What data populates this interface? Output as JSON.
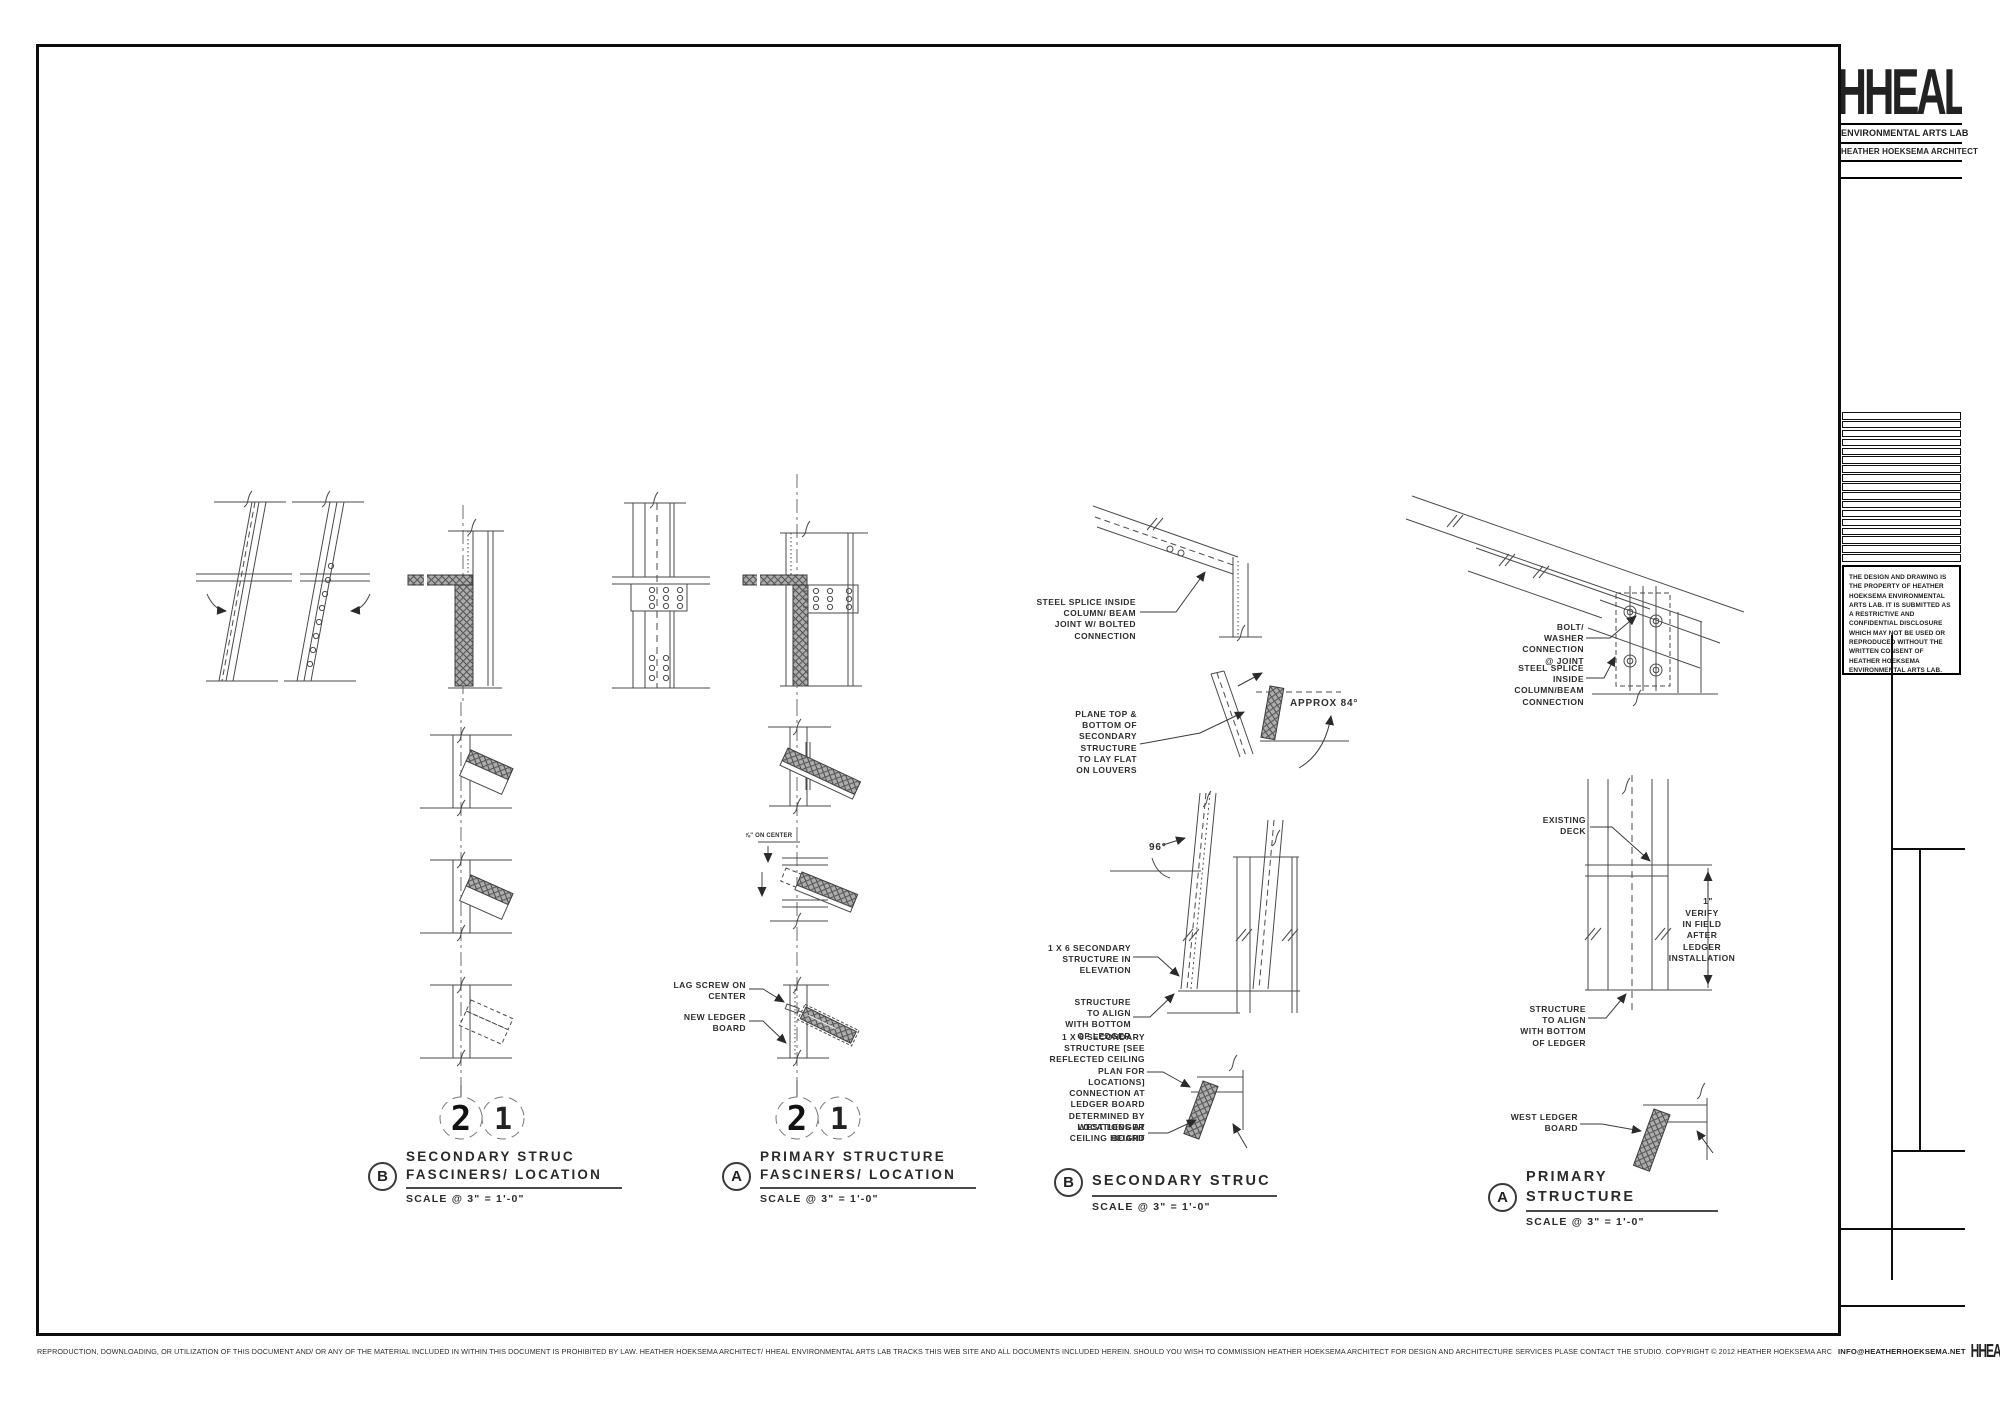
{
  "titleblock": {
    "logo": "HHEAL",
    "org": "ENVIRONMENTAL ARTS LAB",
    "architect": "HEATHER HOEKSEMA ARCHITECT",
    "disclaimer": "THE DESIGN AND DRAWING IS THE PROPERTY OF HEATHER HOEKSEMA ENVIRONMENTAL ARTS LAB.  IT IS SUBMITTED AS A RESTRICTIVE AND CONFIDENTIAL DISCLOSURE WHICH MAY NOT BE USED OR REPRODUCED WITHOUT THE WRITTEN CONSENT OF HEATHER HOEKSEMA ENVIRONMENTAL ARTS LAB."
  },
  "footer": {
    "legal": "REPRODUCTION, DOWNLOADING, OR UTILIZATION OF THIS DOCUMENT AND/ OR ANY OF THE MATERIAL INCLUDED IN WITHIN THIS DOCUMENT IS PROHIBITED BY LAW.  HEATHER HOEKSEMA ARCHITECT/ HHEAL ENVIRONMENTAL ARTS LAB TRACKS THIS WEB SITE AND ALL DOCUMENTS INCLUDED HEREIN.  SHOULD YOU WISH TO COMMISSION HEATHER HOEKSEMA ARCHITECT FOR DESIGN AND ARCHITECTURE SERVICES PLASE CONTACT THE STUDIO.   COPYRIGHT © 2012 HEATHER HOEKSEMA ARCHITECT/ HHEAL ENVIRONMENTAL ARTS LAB",
    "email": "INFO@HEATHERHOEKSEMA.NET",
    "logo": "HHEAL"
  },
  "colors": {
    "line": "#4a4a4a",
    "hatch_fill": "#a9a9a9",
    "ink": "#1c1c1c"
  },
  "panels": [
    {
      "letter": "B",
      "bubbles": {
        "left": "2",
        "right": "1"
      },
      "title": "SECONDARY STRUC\nFASCINERS/ LOCATION",
      "scale": "SCALE @ 3\" = 1'-0\""
    },
    {
      "letter": "A",
      "bubbles": {
        "left": "2",
        "right": "1"
      },
      "title": "PRIMARY STRUCTURE\nFASCINERS/ LOCATION",
      "scale": "SCALE @ 3\" = 1'-0\"",
      "annotations": {
        "dim_on_center": "⅞\" ON CENTER",
        "lag_screw": "LAG SCREW ON\nCENTER",
        "new_ledger": "NEW LEDGER\nBOARD"
      }
    },
    {
      "letter": "B",
      "title": "SECONDARY STRUC",
      "scale": "SCALE @ 3\" = 1'-0\"",
      "annotations": {
        "steel_splice": "STEEL SPLICE INSIDE\nCOLUMN/ BEAM\nJOINT W/ BOLTED\nCONNECTION",
        "plane": "PLANE TOP &\nBOTTOM OF\nSECONDARY\nSTRUCTURE\nTO LAY FLAT\nON LOUVERS",
        "approx_angle": "APPROX 84°",
        "angle_96": "96°",
        "elevation": "1 X 6 SECONDARY\nSTRUCTURE IN\nELEVATION",
        "align": "STRUCTURE\nTO ALIGN\nWITH BOTTOM\nOF LEDGER",
        "connection": "1 X 6 SECONDARY\nSTRUCTURE [SEE\nREFLECTED CEILING\nPLAN FOR\nLOCATIONS]\nCONNECTION AT\nLEDGER BOARD\nDETERMINED BY\nLOCATIONS AT\nCEILING HEIGHT",
        "west_ledger": "WEST LEDGER\nBOARD"
      }
    },
    {
      "letter": "A",
      "title": "PRIMARY STRUCTURE",
      "scale": "SCALE @ 3\" = 1'-0\"",
      "annotations": {
        "bolt_washer": "BOLT/\nWASHER\nCONNECTION\n@ JOINT",
        "steel_splice": "STEEL SPLICE\nINSIDE\nCOLUMN/BEAM\nCONNECTION",
        "existing_deck": "EXISTING\nDECK",
        "dim_one_inch": "1\"",
        "verify": "VERIFY\nIN FIELD\nAFTER\nLEDGER\nINSTALLATION",
        "align": "STRUCTURE\nTO ALIGN\nWITH BOTTOM\nOF LEDGER",
        "west_ledger": "WEST LEDGER\nBOARD"
      }
    }
  ]
}
